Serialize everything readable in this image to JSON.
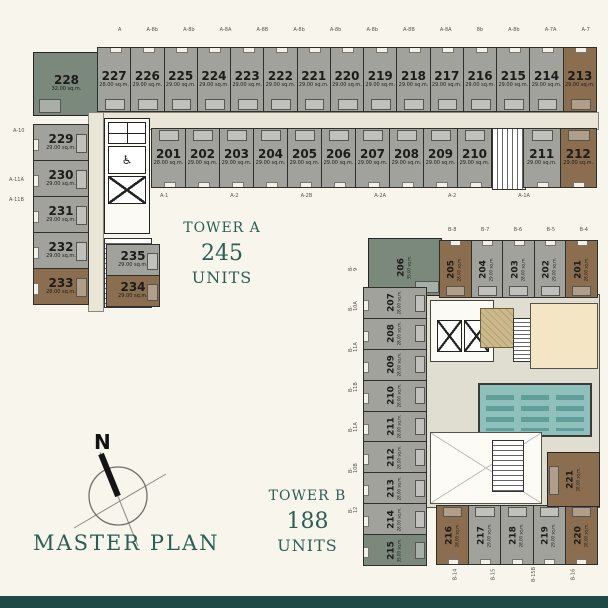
{
  "palette": {
    "background": "#f7f5ec",
    "unit_gray": "#a2a29d",
    "unit_brown": "#8b6e50",
    "unit_sage": "#7b887c",
    "corridor": "#eae6d7",
    "pool": "#8fc0bb",
    "pool_lane": "#5f9e99",
    "fitness": "#f4e5c4",
    "accent_green": "#2c5f53",
    "footer_bar": "#1d4a44"
  },
  "title": {
    "text": "MASTER PLAN"
  },
  "compass": {
    "north_label": "N"
  },
  "icons": {
    "wheelchair": "♿"
  },
  "tower_a": {
    "name": "TOWER A",
    "units_count": "245",
    "units_word": "UNITS",
    "corner_unit": {
      "no": "228",
      "area": "32.00 sq.m."
    },
    "top_row": [
      {
        "no": "227",
        "area": "28.00 sq.m."
      },
      {
        "no": "226",
        "area": "29.00 sq.m."
      },
      {
        "no": "225",
        "area": "29.00 sq.m."
      },
      {
        "no": "224",
        "area": "29.00 sq.m."
      },
      {
        "no": "223",
        "area": "29.00 sq.m."
      },
      {
        "no": "222",
        "area": "29.00 sq.m."
      },
      {
        "no": "221",
        "area": "29.00 sq.m."
      },
      {
        "no": "220",
        "area": "29.00 sq.m."
      },
      {
        "no": "219",
        "area": "29.00 sq.m."
      },
      {
        "no": "218",
        "area": "29.00 sq.m."
      },
      {
        "no": "217",
        "area": "29.00 sq.m."
      },
      {
        "no": "216",
        "area": "29.00 sq.m."
      },
      {
        "no": "215",
        "area": "29.00 sq.m."
      },
      {
        "no": "214",
        "area": "29.00 sq.m."
      },
      {
        "no": "213",
        "area": "29.00 sq.m.",
        "type": "brown"
      }
    ],
    "second_row": [
      {
        "no": "201",
        "area": "28.00 sq.m."
      },
      {
        "no": "202",
        "area": "29.00 sq.m."
      },
      {
        "no": "203",
        "area": "29.00 sq.m."
      },
      {
        "no": "204",
        "area": "29.00 sq.m."
      },
      {
        "no": "205",
        "area": "29.00 sq.m."
      },
      {
        "no": "206",
        "area": "29.00 sq.m."
      },
      {
        "no": "207",
        "area": "29.00 sq.m."
      },
      {
        "no": "208",
        "area": "29.00 sq.m."
      },
      {
        "no": "209",
        "area": "29.00 sq.m."
      },
      {
        "no": "210",
        "area": "29.00 sq.m."
      }
    ],
    "second_row_right": [
      {
        "no": "211",
        "area": "29.00 sq.m."
      },
      {
        "no": "212",
        "area": "29.00 sq.m.",
        "type": "brown"
      }
    ],
    "left_column": [
      {
        "no": "229",
        "area": "29.00 sq.m."
      },
      {
        "no": "230",
        "area": "29.00 sq.m."
      },
      {
        "no": "231",
        "area": "29.00 sq.m."
      },
      {
        "no": "232",
        "area": "29.00 sq.m."
      },
      {
        "no": "233",
        "area": "28.00 sq.m.",
        "type": "brown"
      }
    ],
    "inner_column": [
      {
        "no": "235",
        "area": "29.00 sq.m."
      },
      {
        "no": "234",
        "area": "29.00 sq.m.",
        "type": "brown"
      }
    ],
    "grid_labels_top": [
      "A",
      "A-8b",
      "A-8b",
      "A-8A",
      "A-8B",
      "A-8b",
      "A-8b",
      "A-8b",
      "A-8B",
      "A-8A",
      "8b",
      "A-8b",
      "A-7A",
      "A-7"
    ],
    "grid_labels_left": [
      "A-10",
      "A-11A",
      "A-11B"
    ],
    "grid_labels_bottom": [
      "A-1",
      "A-2",
      "A-2B",
      "A-2A",
      "A-2",
      "A-1A"
    ]
  },
  "tower_b": {
    "name": "TOWER B",
    "units_count": "188",
    "units_word": "UNITS",
    "corner_unit_top": {
      "no": "206",
      "area": "35.00 sq.m."
    },
    "top_row": [
      {
        "no": "205",
        "area": "28.00 sq.m.",
        "type": "brown"
      },
      {
        "no": "204",
        "area": "29.00 sq.m."
      },
      {
        "no": "203",
        "area": "28.00 sq.m."
      },
      {
        "no": "202",
        "area": "29.00 sq.m."
      },
      {
        "no": "201",
        "area": "28.00 sq.m.",
        "type": "brown"
      }
    ],
    "left_column": [
      {
        "no": "207",
        "area": "28.00 sq.m."
      },
      {
        "no": "208",
        "area": "28.00 sq.m."
      },
      {
        "no": "209",
        "area": "28.00 sq.m."
      },
      {
        "no": "210",
        "area": "28.00 sq.m."
      },
      {
        "no": "211",
        "area": "28.00 sq.m."
      },
      {
        "no": "212",
        "area": "28.00 sq.m."
      },
      {
        "no": "213",
        "area": "28.00 sq.m."
      },
      {
        "no": "214",
        "area": "28.00 sq.m."
      },
      {
        "no": "215",
        "area": "35.00 sq.m.",
        "type": "sage"
      }
    ],
    "bottom_row": [
      {
        "no": "216",
        "area": "28.00 sq.m.",
        "type": "brown"
      },
      {
        "no": "217",
        "area": "29.00 sq.m."
      },
      {
        "no": "218",
        "area": "28.00 sq.m."
      },
      {
        "no": "219",
        "area": "29.00 sq.m."
      },
      {
        "no": "220",
        "area": "28.00 sq.m.",
        "type": "brown"
      }
    ],
    "right_unit": {
      "no": "221",
      "area": "28.00 sq.m."
    },
    "grid_labels_top": [
      "B-8",
      "B-7",
      "B-6",
      "B-5",
      "B-4"
    ],
    "grid_labels_left": [
      "B-9",
      "B-10A",
      "B-11A",
      "B-11B",
      "B-11A",
      "B-10B",
      "B-12"
    ],
    "grid_labels_bottom": [
      "B-14",
      "B-15",
      "B-15B",
      "B-16"
    ]
  }
}
